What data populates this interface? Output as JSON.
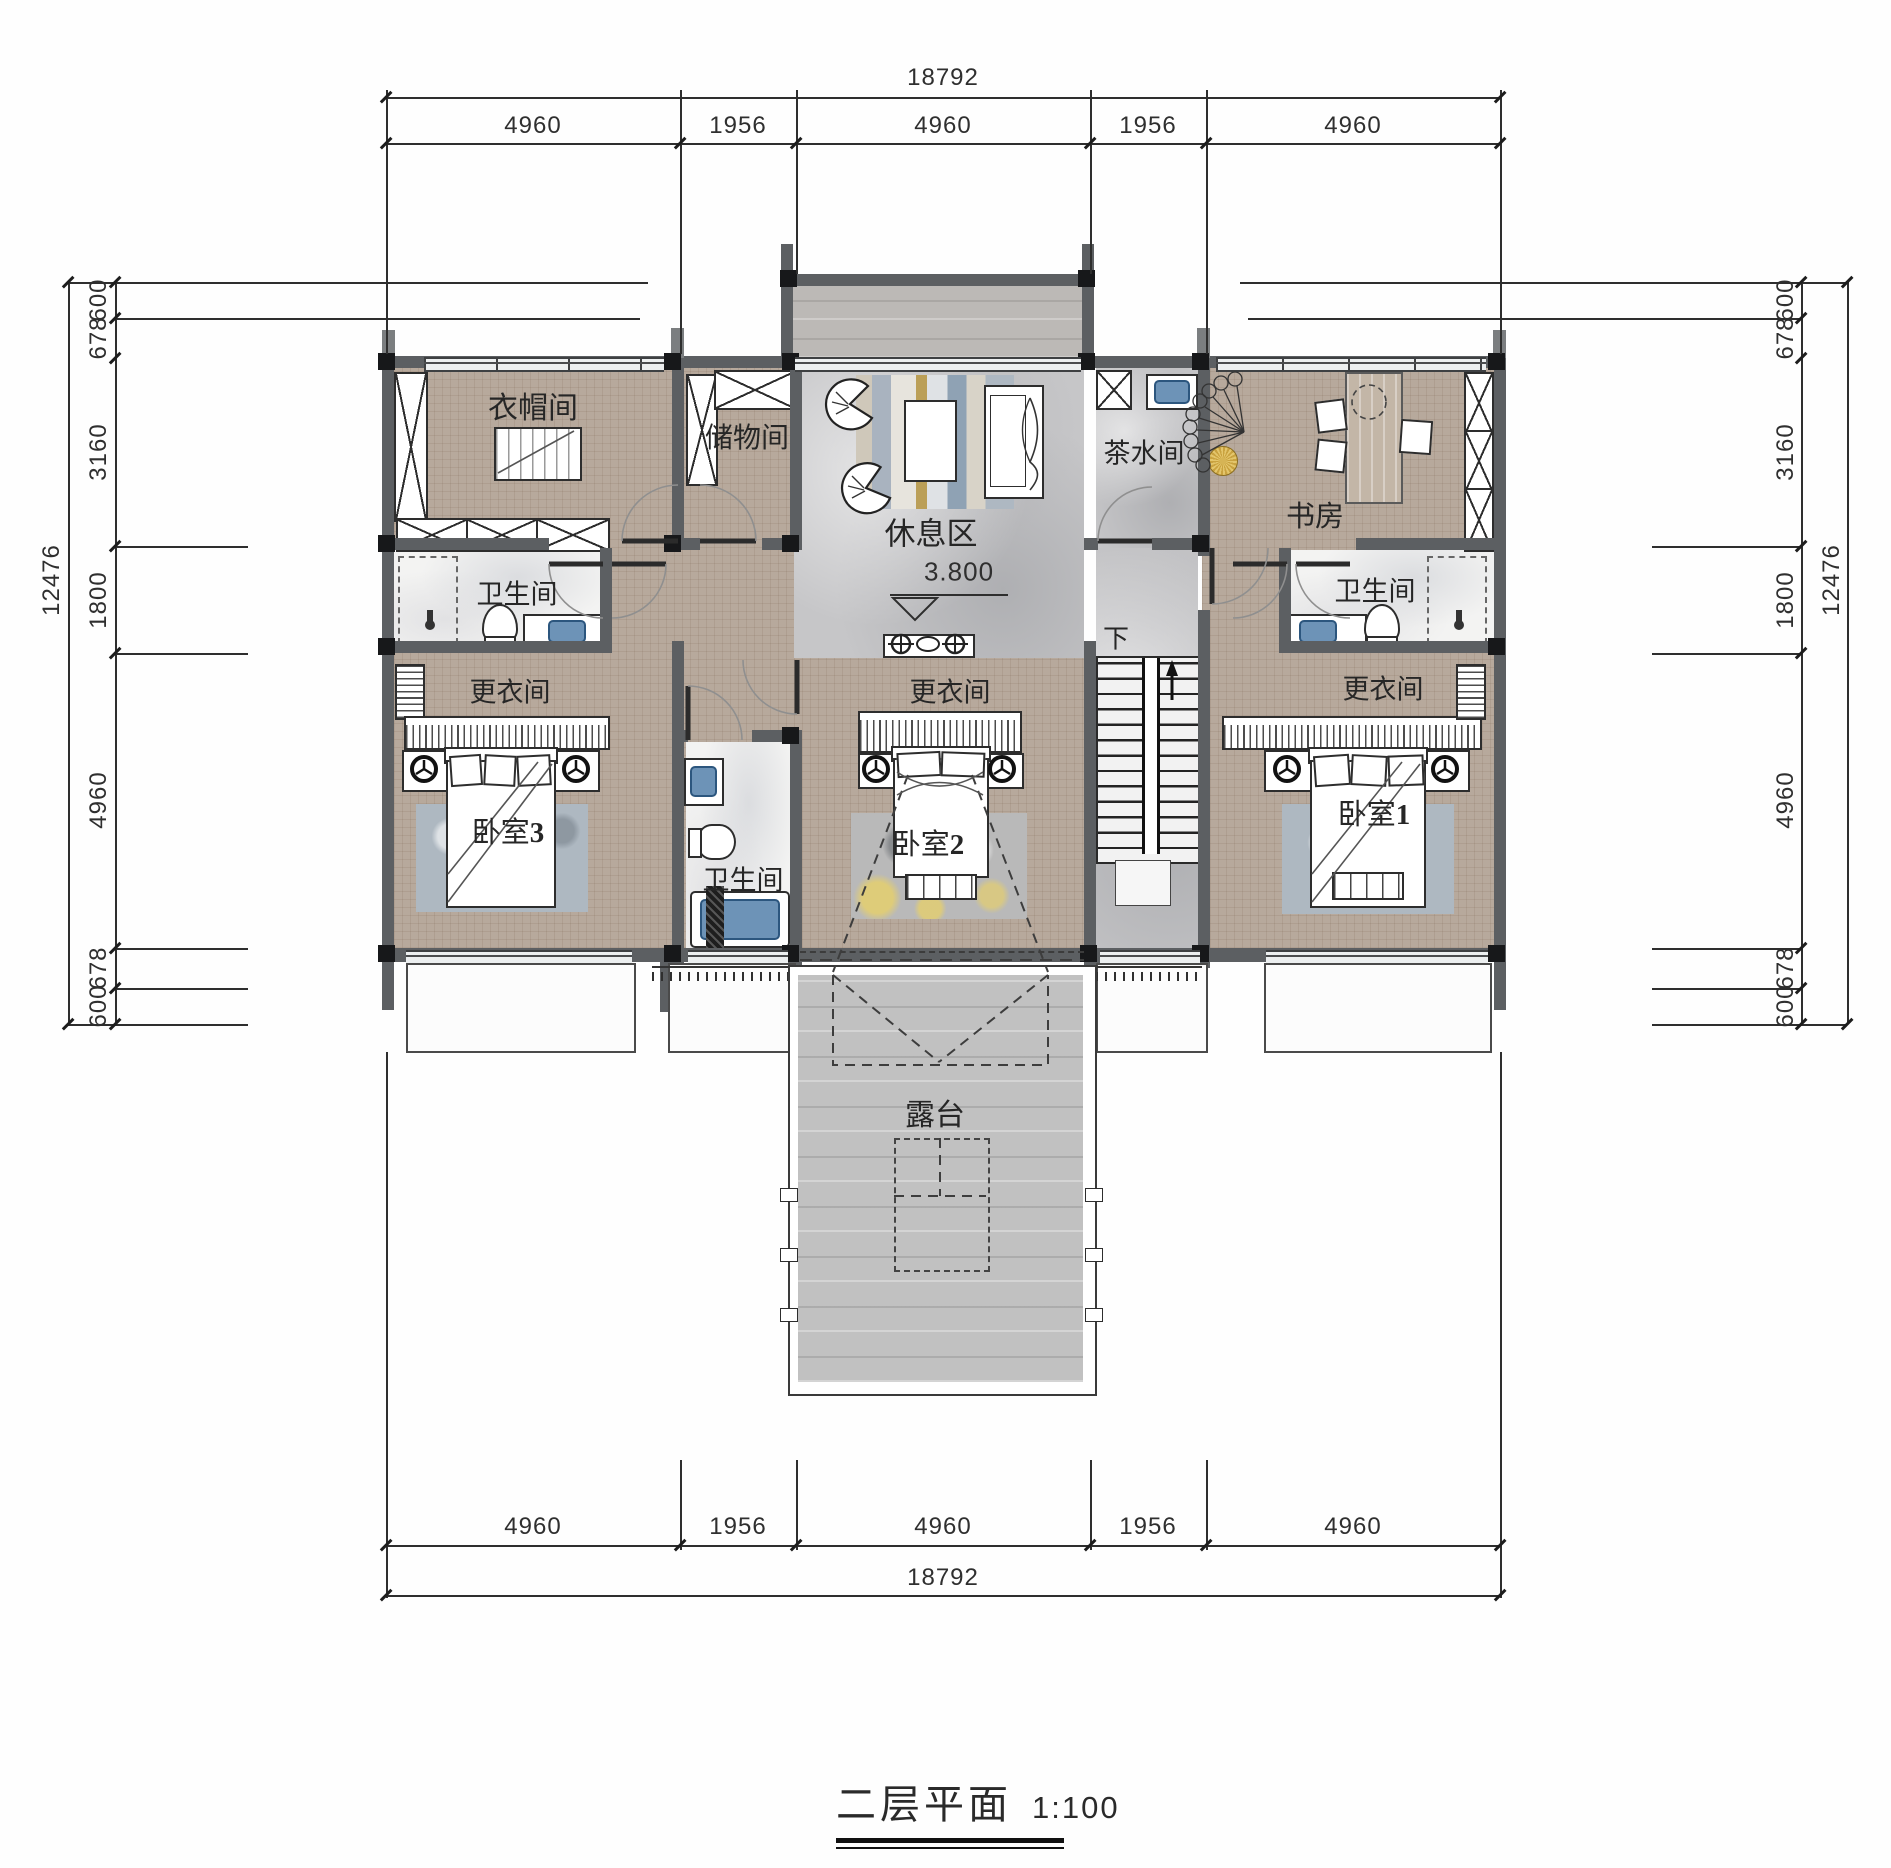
{
  "drawing": {
    "title": "二层平面",
    "scale": "1:100"
  },
  "dimensions": {
    "top": {
      "total": "18792",
      "segments": [
        "4960",
        "1956",
        "4960",
        "1956",
        "4960"
      ]
    },
    "bottom": {
      "total": "18792",
      "segments": [
        "4960",
        "1956",
        "4960",
        "1956",
        "4960"
      ]
    },
    "left": {
      "total": "12476",
      "segments": [
        "600",
        "678",
        "3160",
        "1800",
        "4960",
        "678",
        "600"
      ]
    },
    "right": {
      "total": "12476",
      "segments": [
        "600",
        "678",
        "3160",
        "1800",
        "4960",
        "678",
        "600"
      ]
    }
  },
  "rooms": {
    "cloakroom": "衣帽间",
    "storage": "储物间",
    "lounge": "休息区",
    "tea": "茶水间",
    "study": "书房",
    "bath_left": "卫生间",
    "bath_center": "卫生间",
    "bath_right": "卫生间",
    "dressing_left": "更衣间",
    "dressing_center": "更衣间",
    "dressing_right": "更衣间",
    "bedroom3": {
      "name": "卧室",
      "num": "3"
    },
    "bedroom2": {
      "name": "卧室",
      "num": "2"
    },
    "bedroom1": {
      "name": "卧室",
      "num": "1"
    },
    "terrace": "露台"
  },
  "annotations": {
    "level": "3.800",
    "stairs_down": "下"
  },
  "colors": {
    "wall": "#5c5f62",
    "column": "#17181a",
    "floor_tan": "#b7a99c",
    "floor_stone": "#c6c6c8",
    "floor_wood": "#c1c1c1",
    "basin_blue": "#6d93b7",
    "accent_gold": "#c9a23f"
  }
}
